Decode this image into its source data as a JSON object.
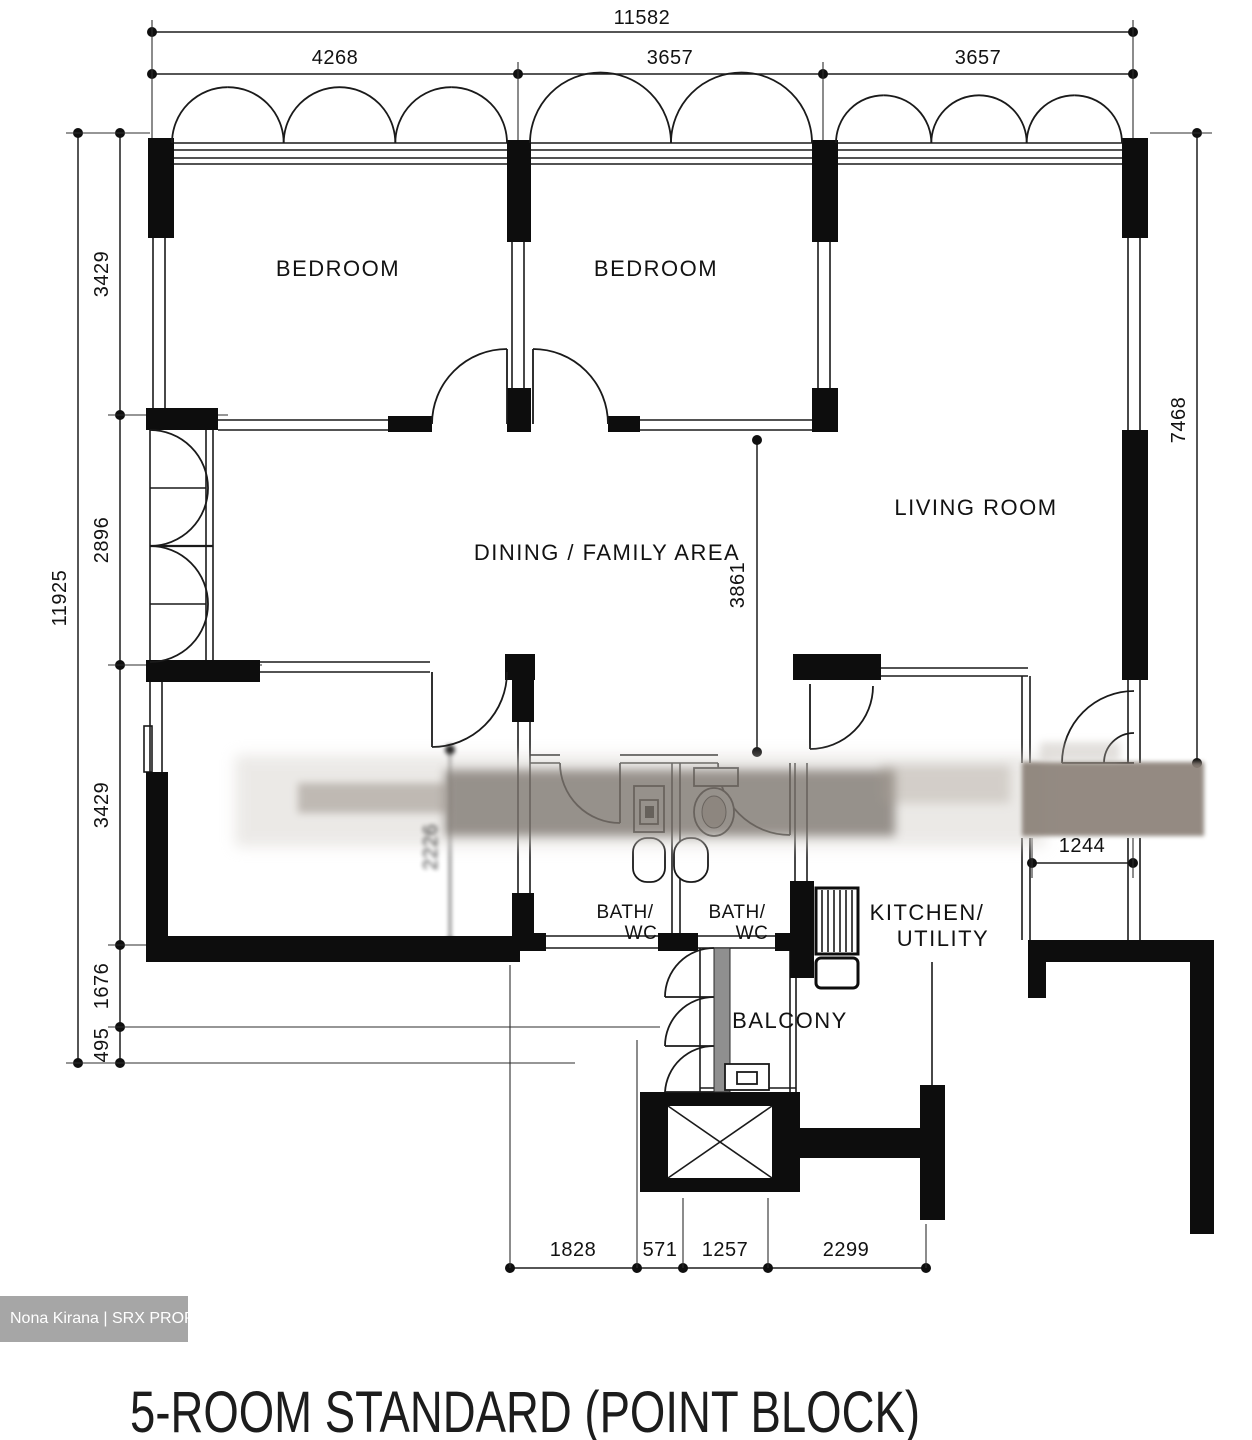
{
  "title": "5-ROOM STANDARD (POINT BLOCK)",
  "watermark": "Nona Kirana | SRX PROPERTY",
  "colors": {
    "ink": "#1a1a1a",
    "watermark_bg": "#a6a6a6"
  },
  "rooms": {
    "bedroom_top_left": "BEDROOM",
    "bedroom_top_mid": "BEDROOM",
    "living_room": "LIVING ROOM",
    "dining": "DINING / FAMILY AREA",
    "bath1_line1": "BATH/",
    "bath1_line2": "WC",
    "bath2_line1": "BATH/",
    "bath2_line2": "WC",
    "kitchen_line1": "KITCHEN/",
    "kitchen_line2": "UTILITY",
    "balcony": "BALCONY"
  },
  "dimensions": {
    "top_total": "11582",
    "top_seg1": "4268",
    "top_seg2": "3657",
    "top_seg3": "3657",
    "left_total": "11925",
    "left_seg1": "3429",
    "left_seg2": "2896",
    "left_seg3": "3429",
    "left_seg4": "1676",
    "left_seg5": "495",
    "right_total": "7468",
    "interior_depth": "3861",
    "interior_width_right": "1244",
    "interior_blurred": "2226",
    "bottom_seg1": "1828",
    "bottom_seg2": "571",
    "bottom_seg3": "1257",
    "bottom_seg4": "2299"
  }
}
